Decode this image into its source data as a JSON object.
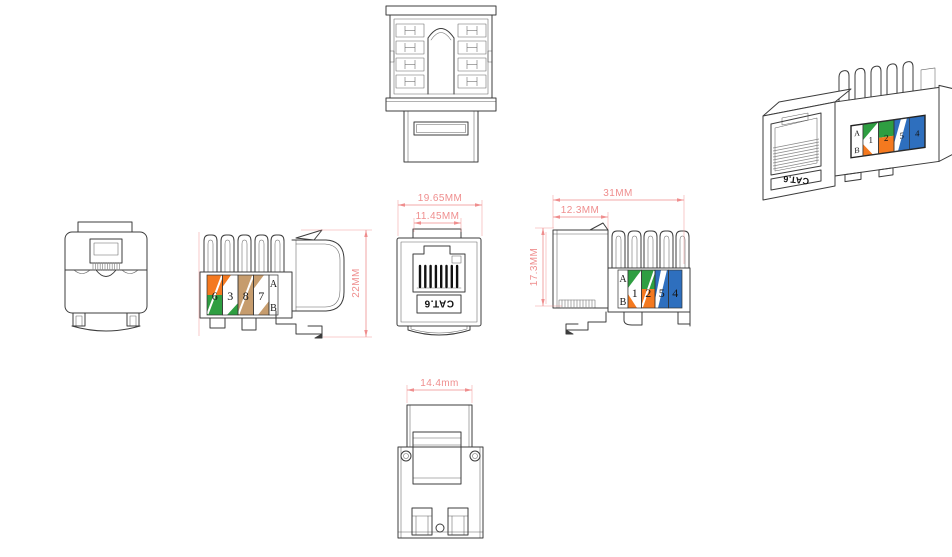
{
  "colors": {
    "line": "#3c3c3c",
    "dim": "#ef8e8e",
    "orange": "#f4791f",
    "green": "#2e9e41",
    "blue": "#2e6fbe",
    "brown": "#c69c6d"
  },
  "dimensions": {
    "front_width": "19.65MM",
    "port_width": "11.45MM",
    "height": "22MM",
    "length": "31MM",
    "rear_depth": "12.3MM",
    "side_height": "17.3MM",
    "bottom_width": "14.4mm"
  },
  "product": {
    "category_label": "CAT.6"
  },
  "wiring_label_left": {
    "scheme_a": "A",
    "scheme_b": "B",
    "slots": [
      "6",
      "3",
      "8",
      "7"
    ]
  },
  "wiring_label_right": {
    "scheme_a": "A",
    "scheme_b": "B",
    "slots": [
      "1",
      "2",
      "5",
      "4"
    ]
  },
  "render_label": {
    "category": "CAT.6",
    "scheme_a": "A",
    "scheme_b": "B",
    "slots": [
      "1",
      "2",
      "5",
      "4"
    ]
  }
}
